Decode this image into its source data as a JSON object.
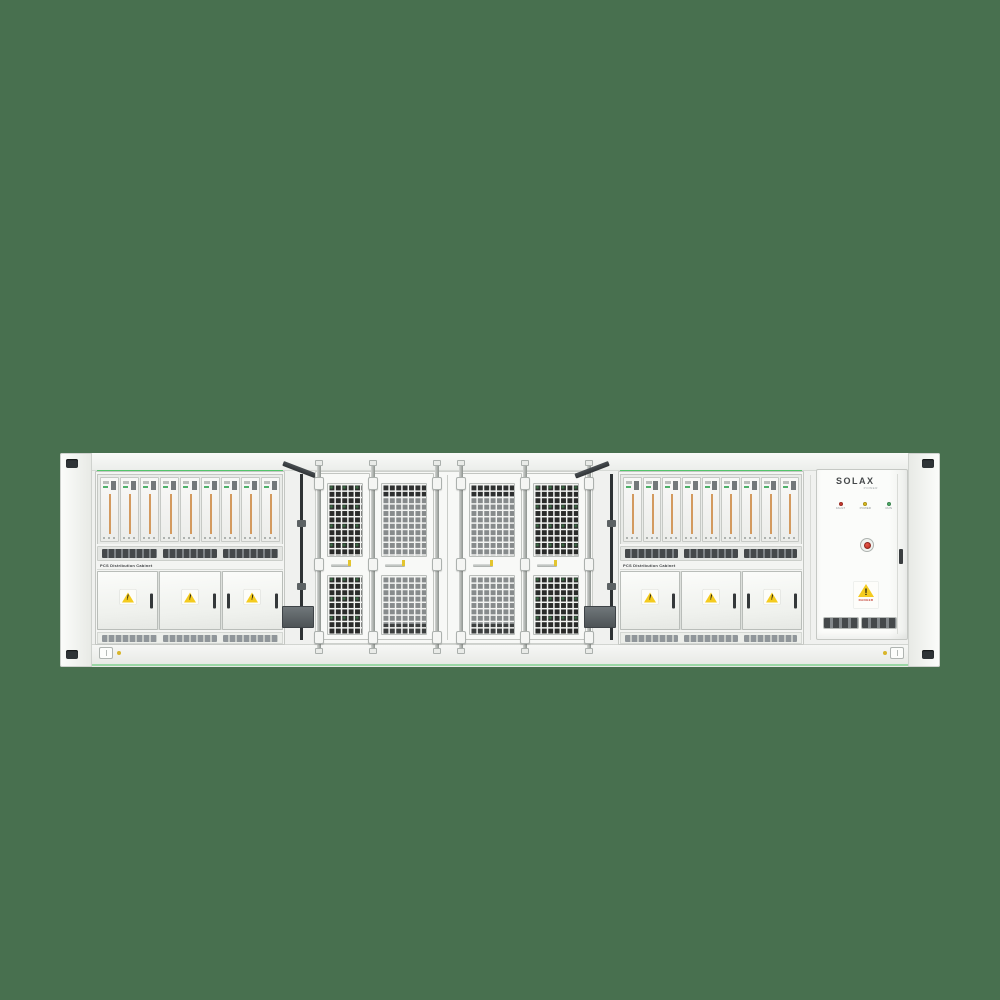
{
  "scene": {
    "background": "#48704F"
  },
  "left_cabinet": {
    "label": "PCS Distribution Cabinet",
    "module_count": 9,
    "door_count": 3
  },
  "right_cabinet": {
    "label": "PCS Distribution Cabinet",
    "module_count": 9,
    "door_count": 3
  },
  "mesh_section": {
    "door_count": 4,
    "tones": [
      "dark",
      "light",
      "light",
      "dark"
    ]
  },
  "solax_cabinet": {
    "brand": "SOLAX",
    "brand_sub": "POWER",
    "leds": [
      {
        "label": "FAULT",
        "color": "#CE3B30"
      },
      {
        "label": "POWER",
        "color": "#E3C21F"
      },
      {
        "label": "RUN",
        "color": "#4FB06A"
      }
    ],
    "warning_text": "DANGER"
  },
  "colors": {
    "container_body": "#F4F5F3",
    "frame_border": "#C5C8C4",
    "mesh_dark": "#2A2B2A",
    "module_accent": "#D39A5F",
    "indicator_green": "#3CC257",
    "warning_yellow": "#F4CB1E"
  }
}
